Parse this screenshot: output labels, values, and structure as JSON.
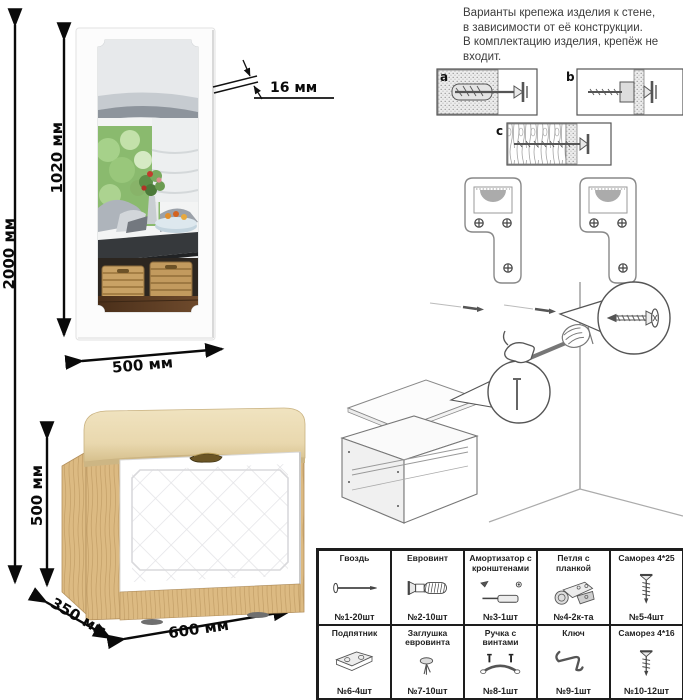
{
  "header_note": {
    "lines": [
      "Варианты крепежа изделия к стене,",
      "в зависимости от её конструкции.",
      "В комплектацию изделия, крепёж не",
      "входит."
    ]
  },
  "dimensions": {
    "total_height": "2000 мм",
    "mirror_height": "1020 мм",
    "mirror_width": "500 мм",
    "mirror_thickness": "16 мм",
    "bench_height": "500 мм",
    "bench_depth": "350 мм",
    "bench_width": "600 мм"
  },
  "mount_options": {
    "a": "a",
    "b": "b",
    "c": "c"
  },
  "parts_table": {
    "rows": [
      [
        {
          "name": "Гвоздь",
          "qty": "№1-20шт",
          "icon": "nail-icon"
        },
        {
          "name": "Евровинт",
          "qty": "№2-10шт",
          "icon": "confirmat-icon"
        },
        {
          "name": "Амортизатор с кронштенами",
          "qty": "№3-1шт",
          "icon": "gas-strut-icon"
        },
        {
          "name": "Петля с планкой",
          "qty": "№4-2к-та",
          "icon": "hinge-icon"
        },
        {
          "name": "Саморез 4*25",
          "qty": "№5-4шт",
          "icon": "long-screw-icon"
        }
      ],
      [
        {
          "name": "Подпятник",
          "qty": "№6-4шт",
          "icon": "footpad-icon"
        },
        {
          "name": "Заглушка евровинта",
          "qty": "№7-10шт",
          "icon": "euro-cap-icon"
        },
        {
          "name": "Ручка с винтами",
          "qty": "№8-1шт",
          "icon": "handle-icon"
        },
        {
          "name": "Ключ",
          "qty": "№9-1шт",
          "icon": "key-icon"
        },
        {
          "name": "Саморез 4*16",
          "qty": "№10-12шт",
          "icon": "short-screw-icon"
        }
      ]
    ]
  },
  "colors": {
    "wood": "#dcba82",
    "wood_dark": "#c3a069",
    "cushion": "#e9d8ae",
    "door": "#ffffff",
    "line_art": "#666666",
    "dimension": "#0a0a0a",
    "basket": "#c9a265",
    "floor": "#53381f"
  }
}
